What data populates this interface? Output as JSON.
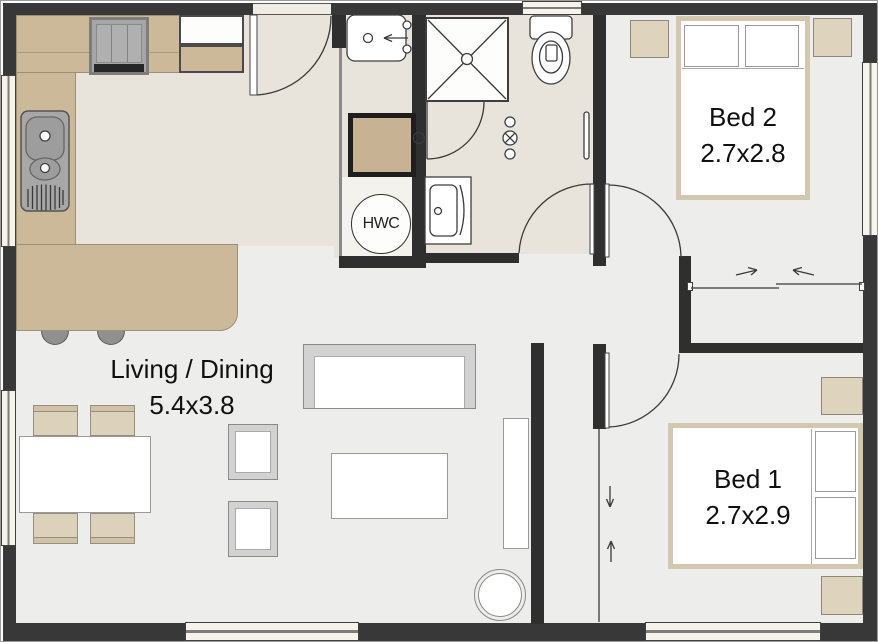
{
  "plan": {
    "rooms": {
      "living_dining": {
        "label": "Living / Dining",
        "size": "5.4x3.8"
      },
      "bed1": {
        "label": "Bed 1",
        "size": "2.7x2.9"
      },
      "bed2": {
        "label": "Bed 2",
        "size": "2.7x2.8"
      }
    },
    "fixtures": {
      "hwc_label": "HWC"
    },
    "colors": {
      "wall": "#383838",
      "floor": "#EDEDEB",
      "wet_area_floor": "#E8E4DB",
      "counter": "#CBB999",
      "timber_furniture": "#DED3BD",
      "window_frame": "#F6F3EA",
      "fixture_outline": "#3E3E3E"
    }
  }
}
